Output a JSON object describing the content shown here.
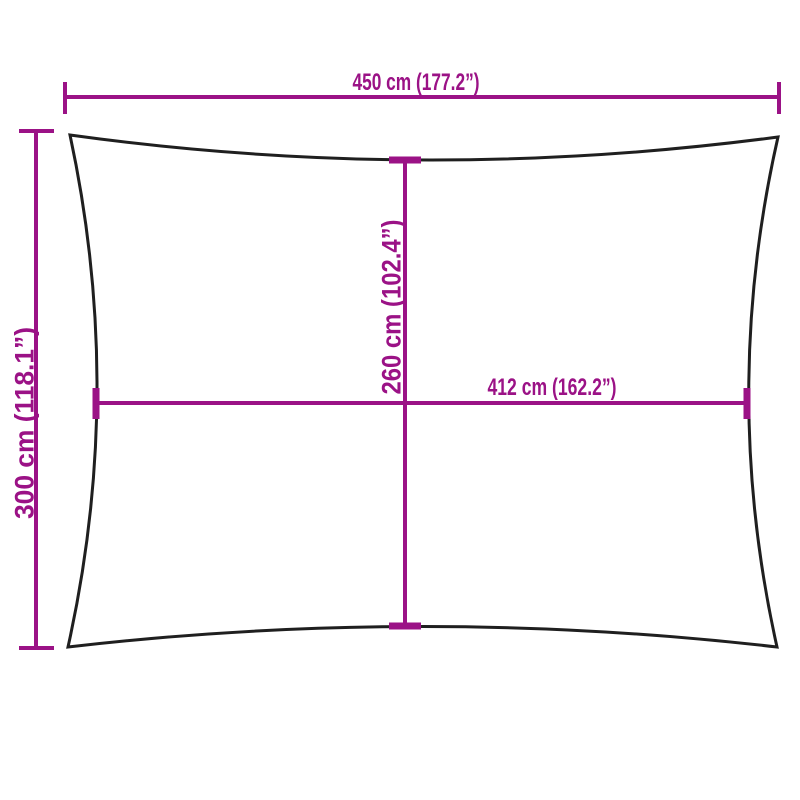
{
  "diagram": {
    "colors": {
      "dimension": "#9B1286",
      "outline": "#1F1F1F",
      "background": "#FFFFFF"
    },
    "dimensions": {
      "overall_width": {
        "label": "450 cm (177.2”)",
        "value_cm": 450,
        "value_in": 177.2
      },
      "overall_height": {
        "label": "300 cm (118.1”)",
        "value_cm": 300,
        "value_in": 118.1
      },
      "inner_height": {
        "label": "260 cm (102.4”)",
        "value_cm": 260,
        "value_in": 102.4
      },
      "inner_width": {
        "label": "412 cm (162.2”)",
        "value_cm": 412,
        "value_in": 162.2
      }
    }
  }
}
